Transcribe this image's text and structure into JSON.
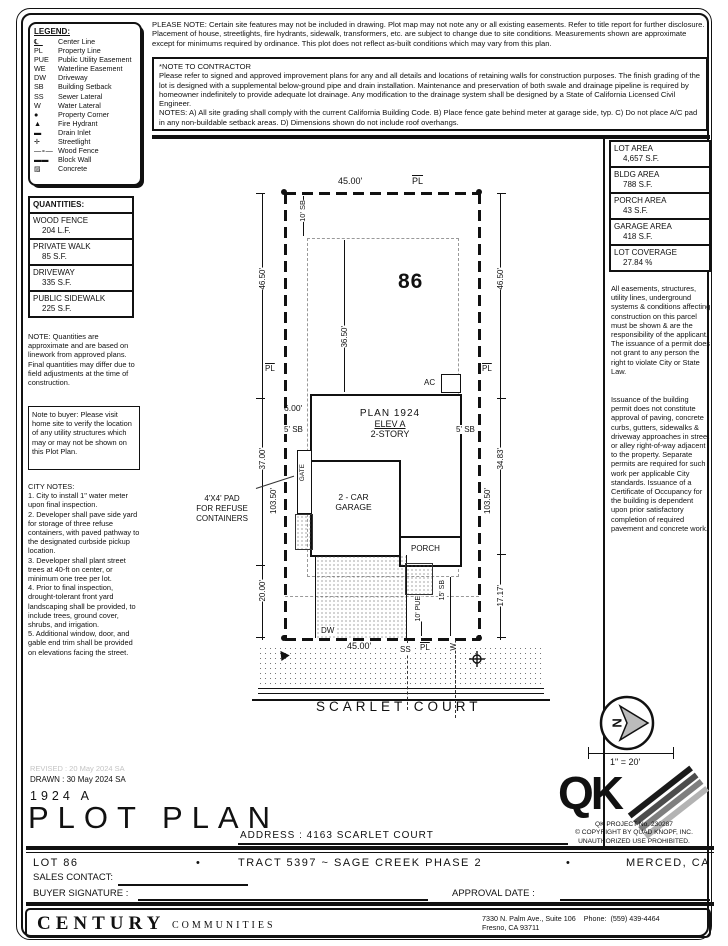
{
  "colors": {
    "ink": "#111111",
    "setback_gray": "#999999",
    "revised_gray": "#c4c4c4"
  },
  "legend": {
    "title": "LEGEND:",
    "items": [
      {
        "symbol": "℄",
        "label": "Center Line"
      },
      {
        "symbol": "PL",
        "label": "Property Line"
      },
      {
        "symbol": "PUE",
        "label": "Public Utility Easement"
      },
      {
        "symbol": "WE",
        "label": "Waterline Easement"
      },
      {
        "symbol": "DW",
        "label": "Driveway"
      },
      {
        "symbol": "SB",
        "label": "Building Setback"
      },
      {
        "symbol": "SS",
        "label": "Sewer Lateral"
      },
      {
        "symbol": "W",
        "label": "Water Lateral"
      },
      {
        "symbol": "●",
        "label": "Property Corner"
      },
      {
        "symbol": "▲",
        "label": "Fire Hydrant"
      },
      {
        "symbol": "▬",
        "label": "Drain Inlet"
      },
      {
        "symbol": "✛",
        "label": "Streetlight"
      },
      {
        "symbol": "—∘—",
        "label": "Wood Fence"
      },
      {
        "symbol": "▬▬",
        "label": "Block Wall"
      },
      {
        "symbol": "▨",
        "label": "Concrete"
      }
    ]
  },
  "please_note": "PLEASE NOTE:  Certain site features may not be included in drawing.  Plot map may not note any or all existing easements. Refer to title report for further disclosure.  Placement of house, streetlights, fire hydrants, sidewalk, transformers, etc. are subject to change due to site conditions.  Measurements shown are approximate except for minimums required by ordinance.  This plot does not reflect as-built conditions which may vary from this plan.",
  "contractor_note": {
    "title": "*NOTE TO CONTRACTOR",
    "body": "Please refer to signed and approved improvement plans for any and all details and locations of retaining walls for construction purposes. The finish grading of the lot is designed with a supplemental below-ground pipe and drain installation.  Maintenance and preservation of both swale and drainage pipeline is required by homeowner indefinitely to provide adequate lot drainage.  Any modification to the drainage system shall be designed by a State of California Licensed Civil Engineer.",
    "notes": "NOTES:  A) All site grading shall comply with the current California Building Code.  B) Place fence gate behind meter at garage side, typ.  C) Do not place A/C pad in any non-buildable setback areas.  D) Dimensions shown do not include roof overhangs."
  },
  "area_table": [
    {
      "label": "LOT AREA",
      "value": "4,657 S.F."
    },
    {
      "label": "BLDG AREA",
      "value": "788 S.F."
    },
    {
      "label": "PORCH AREA",
      "value": "43 S.F."
    },
    {
      "label": "GARAGE AREA",
      "value": "418 S.F."
    },
    {
      "label": "LOT COVERAGE",
      "value": "27.84 %"
    }
  ],
  "right_notes": [
    "All easements, structures, utility lines, underground systems & conditions affecting construction on this parcel must be shown & are the responsibility of the applicant. The issuance of a permit does not grant to any person the right to violate City or State Law.",
    "Issuance of the building permit does not constitute approval of paving, concrete curbs, gutters, sidewalks & driveway approaches in street or alley right-of-way adjacent to the property. Separate permits are required for such work per applicable City standards. Issuance of a Certificate of Occupancy for the building is dependent upon prior satisfactory completion of required pavement and concrete work."
  ],
  "quantities": {
    "title": "QUANTITIES:",
    "items": [
      {
        "label": "WOOD FENCE",
        "value": "204 L.F."
      },
      {
        "label": "PRIVATE WALK",
        "value": "85 S.F."
      },
      {
        "label": "DRIVEWAY",
        "value": "335 S.F."
      },
      {
        "label": "PUBLIC SIDEWALK",
        "value": "225 S.F."
      }
    ],
    "note": "NOTE:  Quantities are approximate and are based on linework from approved plans.  Final quantities may differ due to field adjustments at the time of construction."
  },
  "buyer_note": "Note to buyer: Please visit home site to verify the location of any utility structures which may or may not be shown on this Plot Plan.",
  "city_notes": {
    "title": "CITY NOTES:",
    "items": [
      "1. City to install 1\" water meter upon final inspection.",
      "2. Developer shall pave side yard for storage of three refuse containers, with paved pathway to the designated curbside pickup location.",
      "3. Developer shall plant street trees at 40-ft on center, or minimum one tree per lot.",
      "4. Prior to final inspection, drought-tolerant front yard landscaping shall be provided, to include trees, ground cover, shrubs, and irrigation.",
      "5. Additional window, door, and gable end trim shall be provided on elevations facing the street."
    ]
  },
  "plot": {
    "lot_number": "86",
    "dim_top": "45.00'",
    "dim_bottom": "45.00'",
    "pl": "PL",
    "dim_left_top": "46.50'",
    "dim_left_mid": "37.00'",
    "dim_left_bot": "20.00'",
    "depth_left": "103.50'",
    "dim_right_top": "46.50'",
    "dim_right_mid": "34.83'",
    "dim_right_bot": "17.17'",
    "depth_right": "103.50'",
    "sb_front": "10' SB",
    "dim_front": "36.50'",
    "sb_side": "5' SB",
    "dim_gate": "6.00'",
    "plan": "PLAN 1924",
    "elev": "ELEV A",
    "story": "2-STORY",
    "garage1": "2 - CAR",
    "garage2": "GARAGE",
    "porch": "PORCH",
    "gate": "GATE",
    "ac": "AC",
    "refuse1": "4'X4' PAD",
    "refuse2": "FOR REFUSE",
    "refuse3": "CONTAINERS",
    "dw": "DW",
    "pue": "10' PUE",
    "sb_rear": "15' SB",
    "ss": "SS",
    "w": "W",
    "street": "SCARLET COURT"
  },
  "compass": {
    "north": "N"
  },
  "scale_label": "1\" = 20'",
  "qk": {
    "logo": "QK",
    "project": "QK PROJECT No. 230287",
    "copyright": "© COPYRIGHT BY QUAD KNOPF, INC.",
    "rights": "UNAUTHORIZED USE PROHIBITED."
  },
  "titleblock": {
    "revised": "REVISED :  20 May 2024  SA",
    "drawn": "DRAWN :  30 May 2024  SA",
    "plan_code": "1924  A",
    "title": "PLOT PLAN",
    "address": "ADDRESS :  4163 SCARLET COURT"
  },
  "footer": {
    "lot": "LOT 86",
    "bullet": "•",
    "tract": "TRACT 5397 ~ SAGE CREEK PHASE 2",
    "city": "MERCED, CA",
    "sales": "SALES CONTACT:",
    "buyer": "BUYER SIGNATURE :",
    "approval": "APPROVAL DATE :",
    "brand": "CENTURY",
    "brand_sub": "COMMUNITIES",
    "addr_line1": "7330 N. Palm Ave., Suite 106    Phone:  (559) 439-4464",
    "addr_line2": "Fresno, CA  93711"
  }
}
